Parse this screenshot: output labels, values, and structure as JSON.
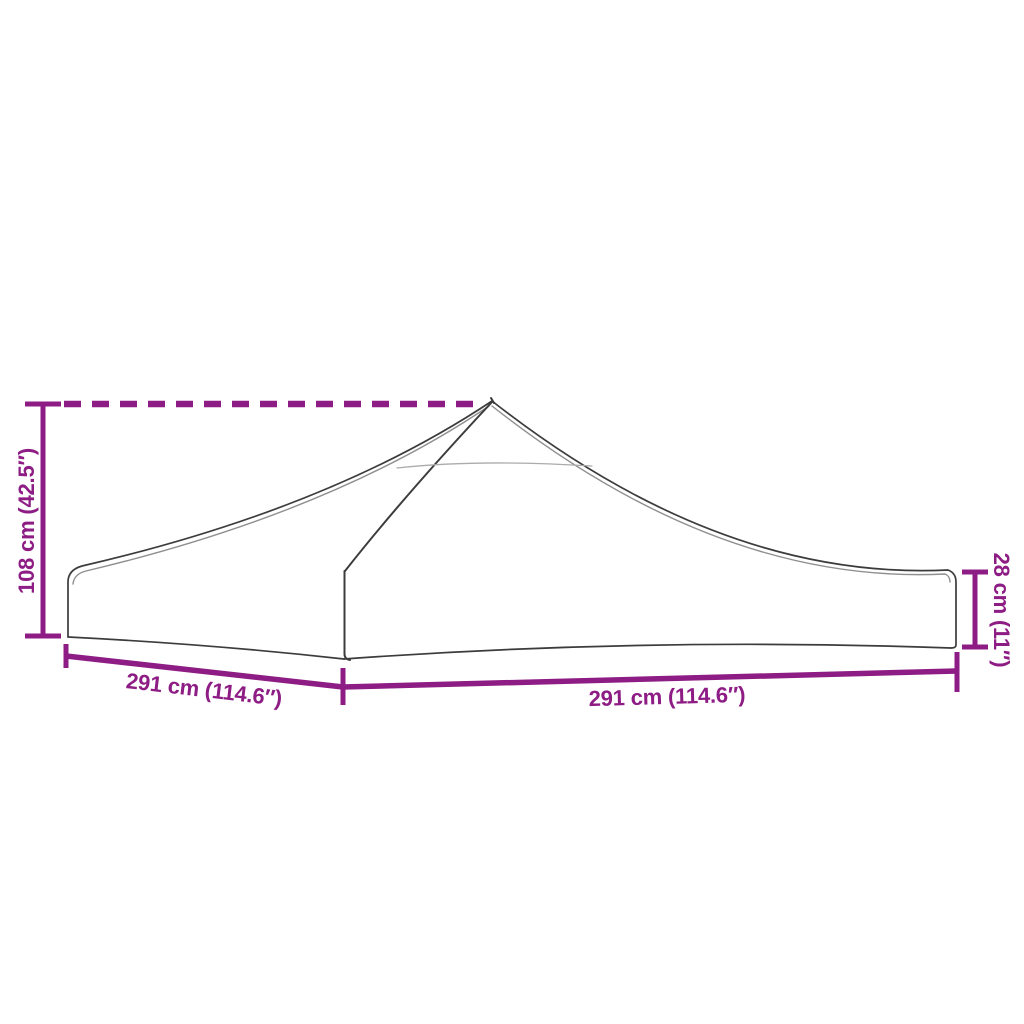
{
  "diagram": {
    "type": "product-dimension-diagram",
    "subject": "party tent / gazebo replacement roof canopy (top view outline)",
    "labels": {
      "height_left": "108 cm (42.5″)",
      "height_right": "28 cm (11″)",
      "width_front_left": "291 cm (114.6″)",
      "width_front_right": "291 cm (114.6″)"
    }
  },
  "colors": {
    "dimension": "#8D1C84",
    "outline": "#3C3C3C",
    "outline_soft": "#8F8F8F",
    "outline_faint": "#ABABAB",
    "background": "#FFFFFF"
  }
}
